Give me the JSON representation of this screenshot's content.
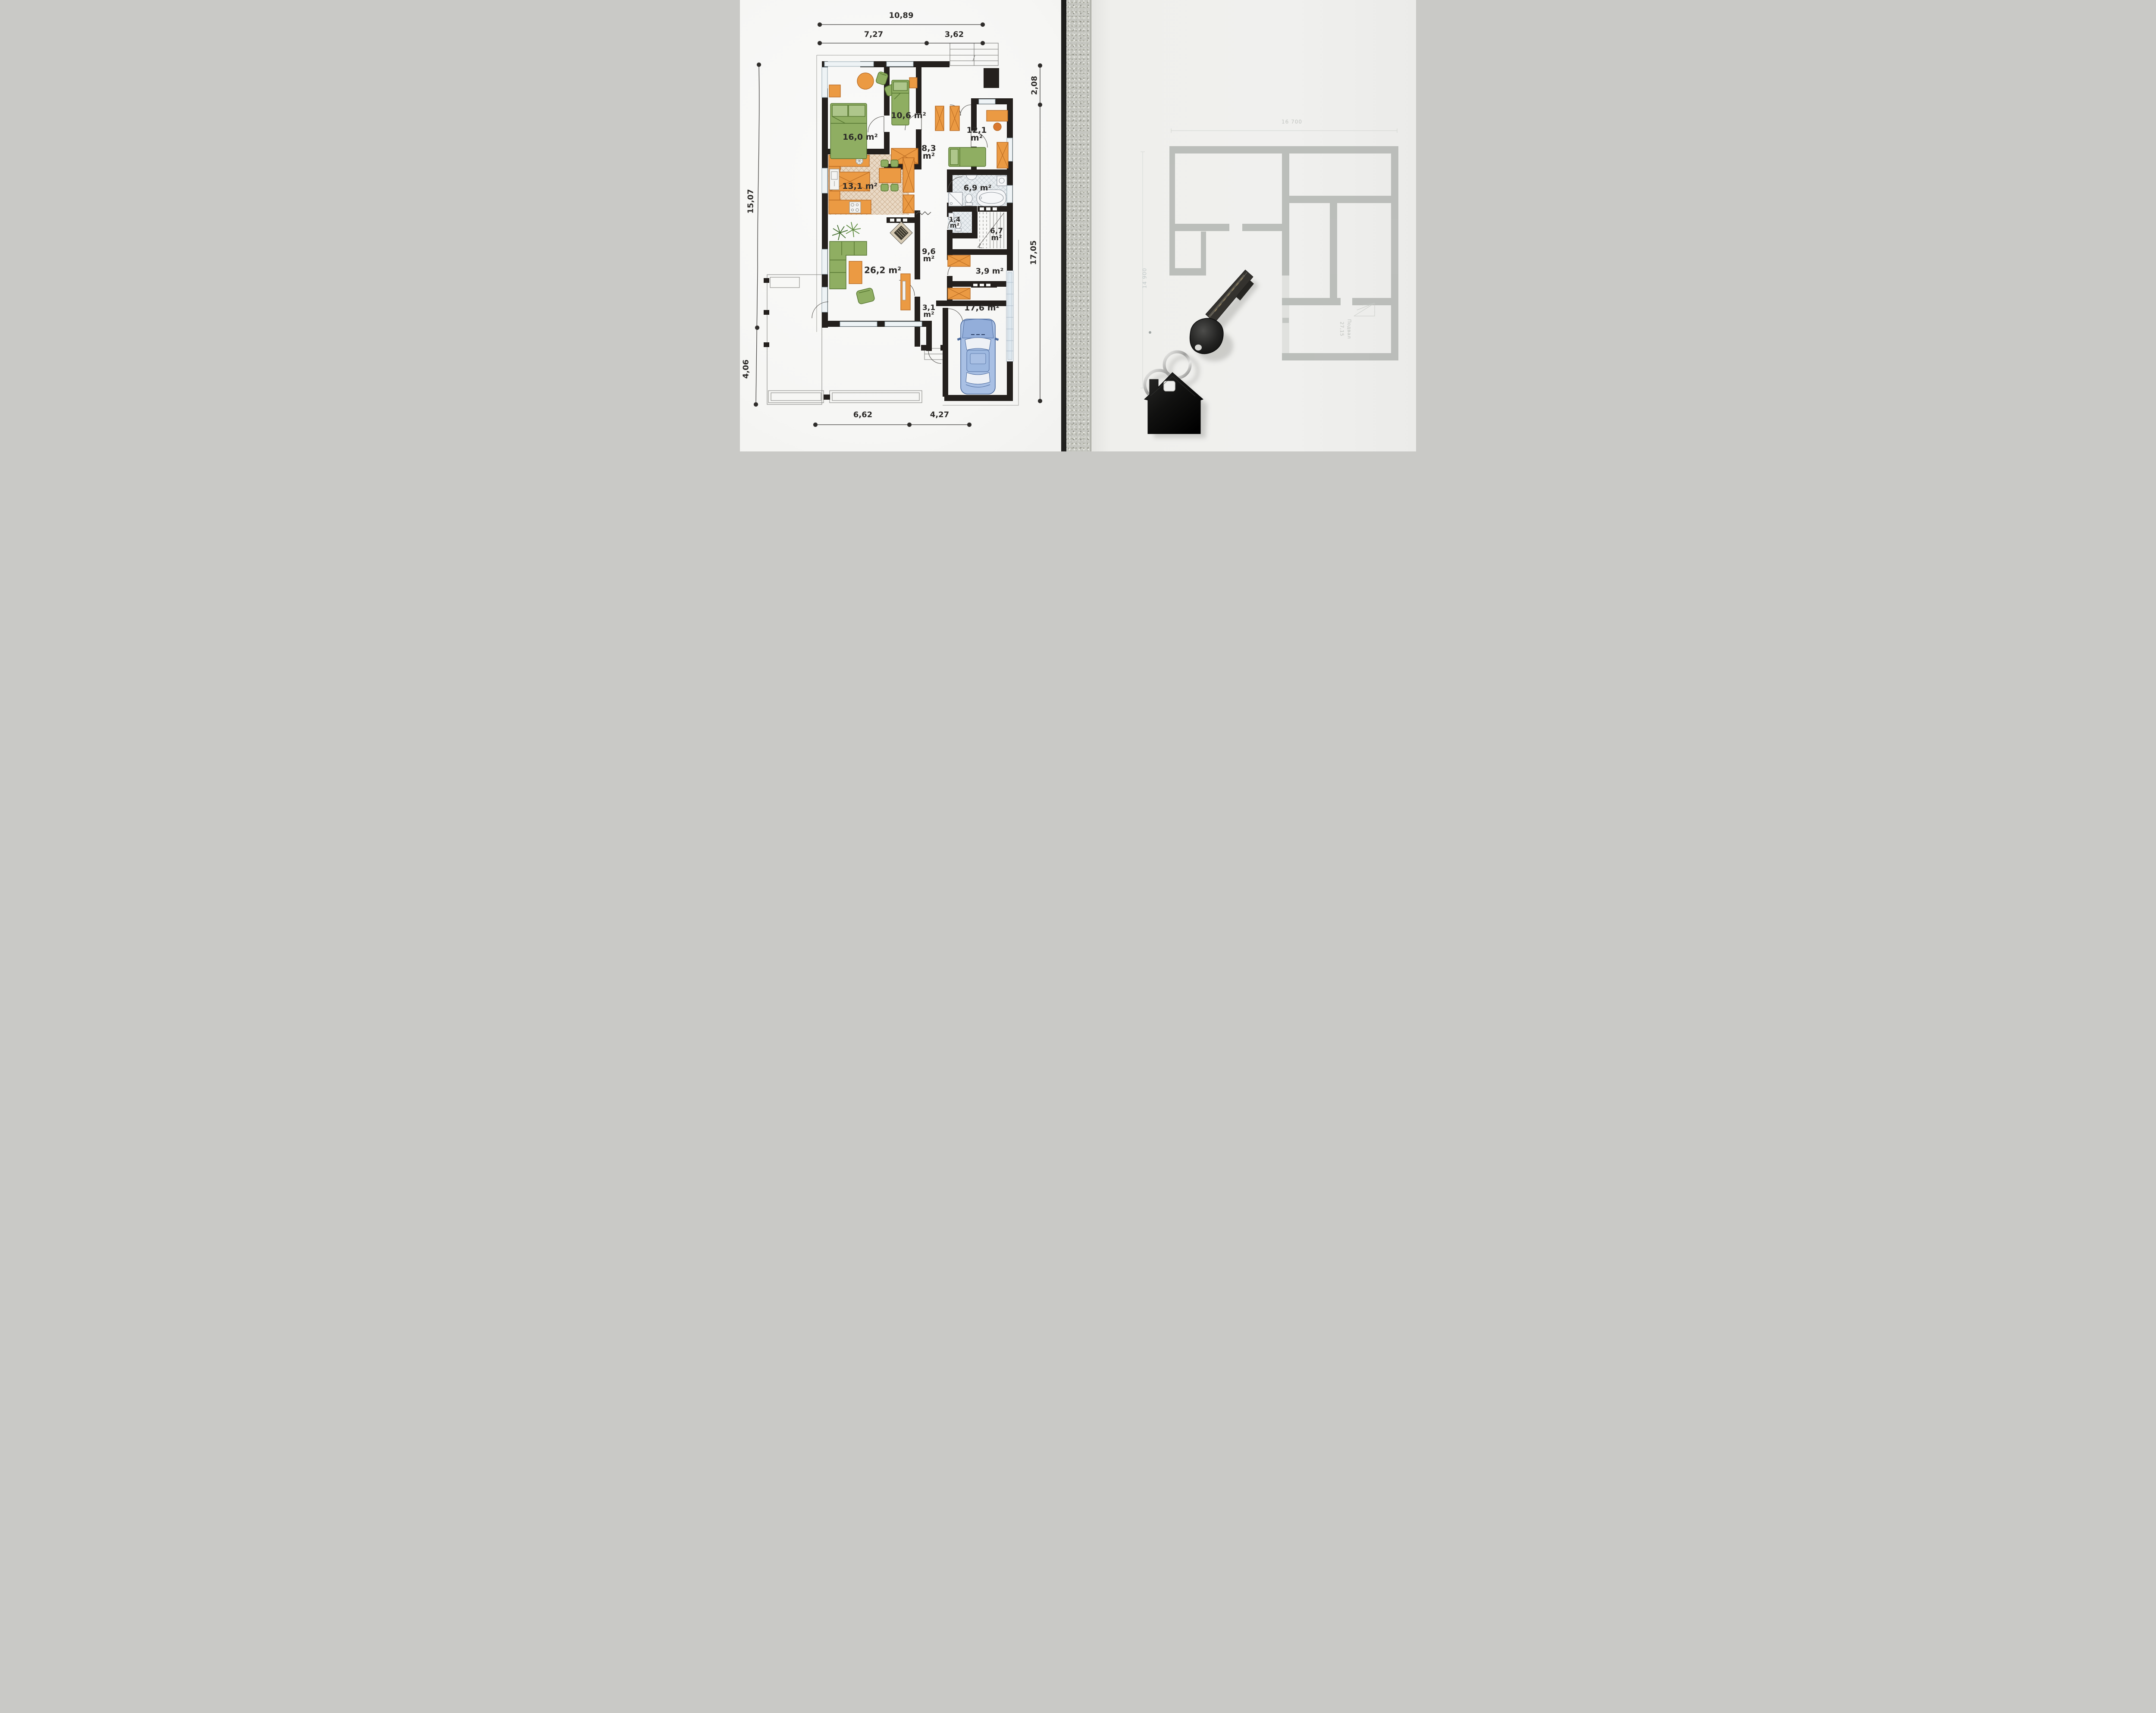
{
  "left_plan": {
    "dimensions": {
      "top_total": "10,89",
      "top_left": "7,27",
      "top_right": "3,62",
      "right_upper": "2,08",
      "right_lower": "17,05",
      "left_upper": "15,07",
      "left_lower": "4,06",
      "bottom_left": "6,62",
      "bottom_right": "4,27"
    },
    "rooms": [
      {
        "id": "bedroom-main",
        "value": "16,0",
        "unit": "m²"
      },
      {
        "id": "bedroom-2",
        "value": "10,6",
        "unit": "m²"
      },
      {
        "id": "bedroom-3",
        "value": "12,1",
        "unit": "m²"
      },
      {
        "id": "hall",
        "value": "8,3",
        "unit": "m²"
      },
      {
        "id": "kitchen",
        "value": "13,1",
        "unit": "m²"
      },
      {
        "id": "bathroom",
        "value": "6,9",
        "unit": "m²"
      },
      {
        "id": "wc",
        "value": "1,4",
        "unit": "m²"
      },
      {
        "id": "stairs",
        "value": "6,7",
        "unit": "m²"
      },
      {
        "id": "corridor",
        "value": "9,6",
        "unit": "m²"
      },
      {
        "id": "living-room",
        "value": "26,2",
        "unit": "m²"
      },
      {
        "id": "storage",
        "value": "3,9",
        "unit": "m²"
      },
      {
        "id": "entry",
        "value": "3,1",
        "unit": "m²"
      },
      {
        "id": "garage",
        "value": "17,6",
        "unit": "m²"
      }
    ]
  },
  "right_plan": {
    "dim_top": "16 700",
    "dim_left": "14 900",
    "room_label": "Подвал",
    "room_area": "27,15"
  },
  "objects": {
    "key": "door-key-with-house-keychain"
  },
  "colors": {
    "wall_black": "#24201d",
    "furniture_orange": "#eb9a43",
    "furniture_green": "#8fae62",
    "car_blue": "#a9c0e4",
    "kitchen_floor": "#e9d9c5",
    "tile_gray": "#e7ebee",
    "faded_plan_gray": "#b7bab6",
    "concrete_gray": "#c5c6c0",
    "paper_left": "#f8f8f6",
    "paper_right": "#efefec"
  }
}
